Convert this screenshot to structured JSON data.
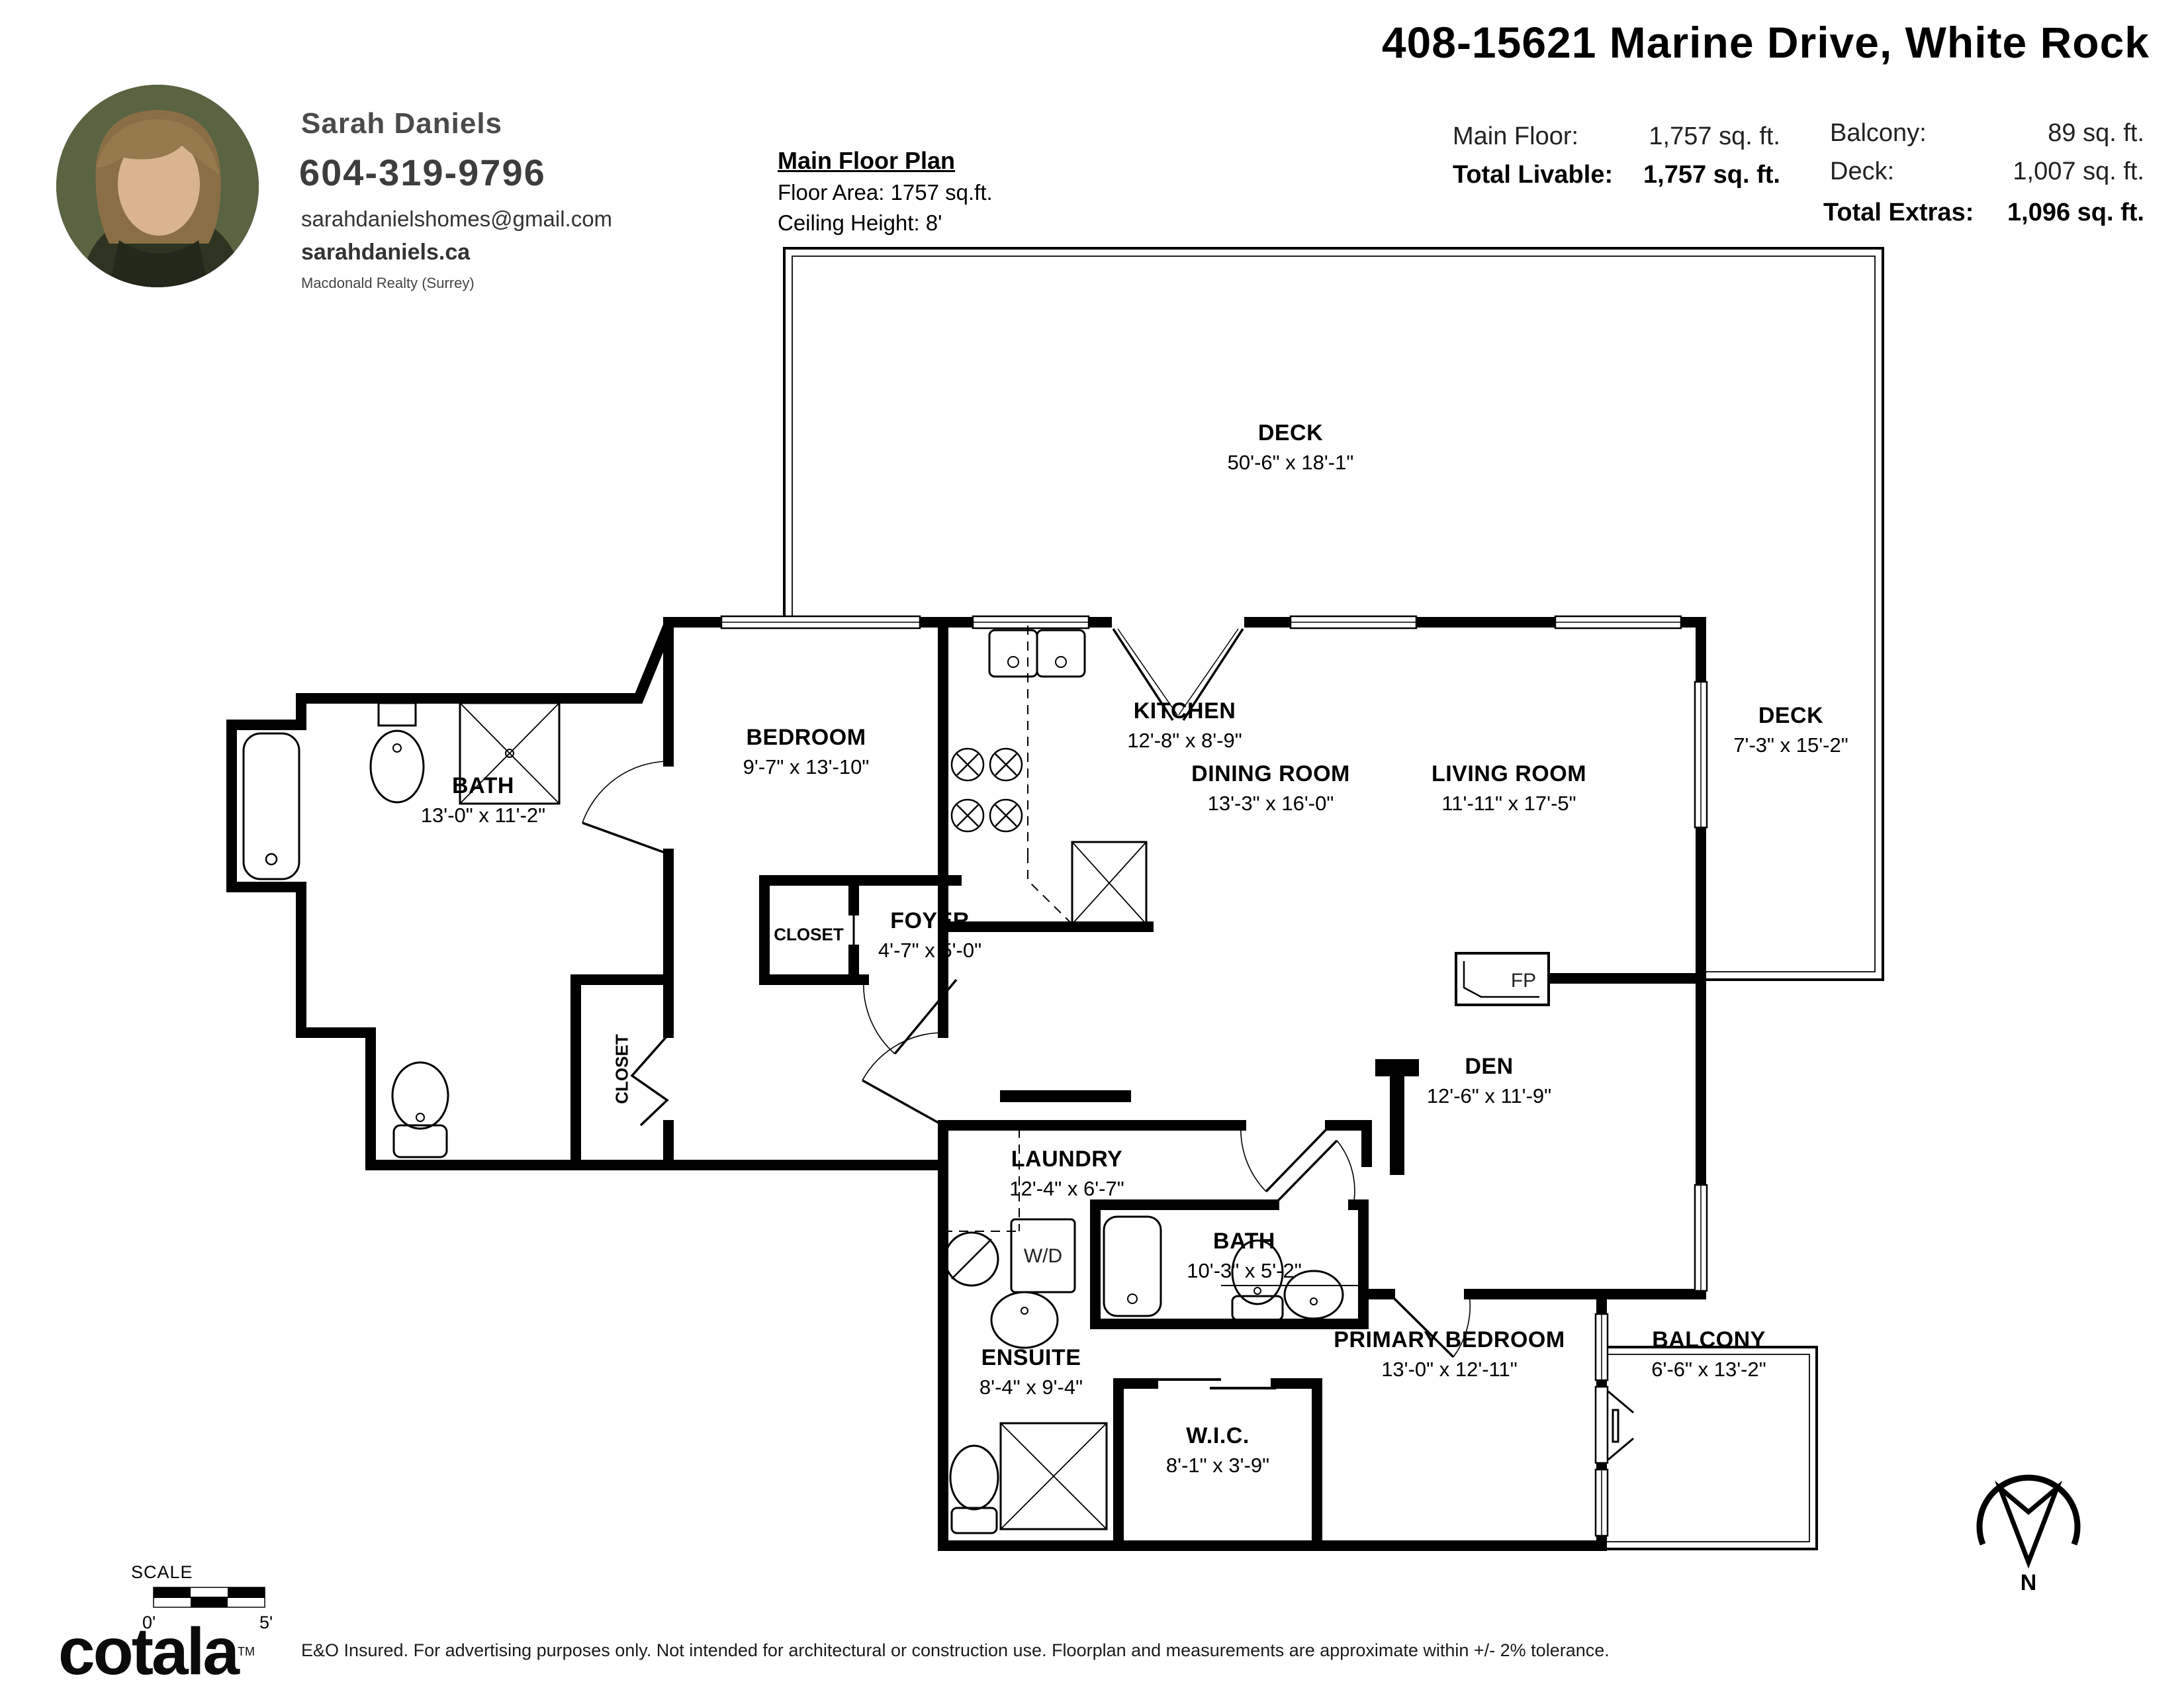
{
  "header": {
    "agent": {
      "name": "Sarah Daniels",
      "phone": "604-319-9796",
      "email": "sarahdanielshomes@gmail.com",
      "website": "sarahdaniels.ca",
      "brokerage": "Macdonald Realty (Surrey)"
    },
    "plan_meta": {
      "title": "Main Floor Plan",
      "floor_area": "Floor Area: 1757 sq.ft.",
      "ceiling": "Ceiling Height: 8'"
    },
    "address": "408-15621 Marine Drive, White Rock",
    "stats": {
      "main_floor_label": "Main Floor:",
      "main_floor_value": "1,757 sq. ft.",
      "total_livable_label": "Total Livable:",
      "total_livable_value": "1,757 sq. ft.",
      "balcony_label": "Balcony:",
      "balcony_value": "89 sq. ft.",
      "deck_label": "Deck:",
      "deck_value": "1,007 sq. ft.",
      "total_extras_label": "Total Extras:",
      "total_extras_value": "1,096 sq. ft."
    }
  },
  "plan": {
    "rooms": {
      "deck_top": {
        "name": "DECK",
        "dims": "50'-6\" x 18'-1\""
      },
      "bath": {
        "name": "BATH",
        "dims": "13'-0\" x 11'-2\""
      },
      "bedroom": {
        "name": "BEDROOM",
        "dims": "9'-7\" x 13'-10\""
      },
      "kitchen": {
        "name": "KITCHEN",
        "dims": "12'-8\" x 8'-9\""
      },
      "dining": {
        "name": "DINING ROOM",
        "dims": "13'-3\" x 16'-0\""
      },
      "living": {
        "name": "LIVING ROOM",
        "dims": "11'-11\" x 17'-5\""
      },
      "deck_right": {
        "name": "DECK",
        "dims": "7'-3\" x 15'-2\""
      },
      "foyer": {
        "name": "FOYER",
        "dims": "4'-7\" x 5'-0\""
      },
      "den": {
        "name": "DEN",
        "dims": "12'-6\" x 11'-9\""
      },
      "laundry": {
        "name": "LAUNDRY",
        "dims": "12'-4\" x 6'-7\""
      },
      "bath2": {
        "name": "BATH",
        "dims": "10'-3\" x 5'-2\""
      },
      "ensuite": {
        "name": "ENSUITE",
        "dims": "8'-4\" x 9'-4\""
      },
      "wic": {
        "name": "W.I.C.",
        "dims": "8'-1\" x 3'-9\""
      },
      "primary": {
        "name": "PRIMARY BEDROOM",
        "dims": "13'-0\" x 12'-11\""
      },
      "balcony": {
        "name": "BALCONY",
        "dims": "6'-6\" x 13'-2\""
      }
    },
    "fixtures": {
      "fp": "FP",
      "wd": "W/D",
      "closet_foyer": "CLOSET",
      "closet_bedroom": "CLOSET"
    },
    "compass_n": "N",
    "scale": {
      "label": "SCALE",
      "start": "0'",
      "end": "5'"
    }
  },
  "footer": {
    "logo": "cotala",
    "tm": "TM",
    "disclaimer": "E&O Insured. For advertising purposes only. Not intended for architectural or construction use. Floorplan and measurements are approximate within +/- 2% tolerance."
  }
}
